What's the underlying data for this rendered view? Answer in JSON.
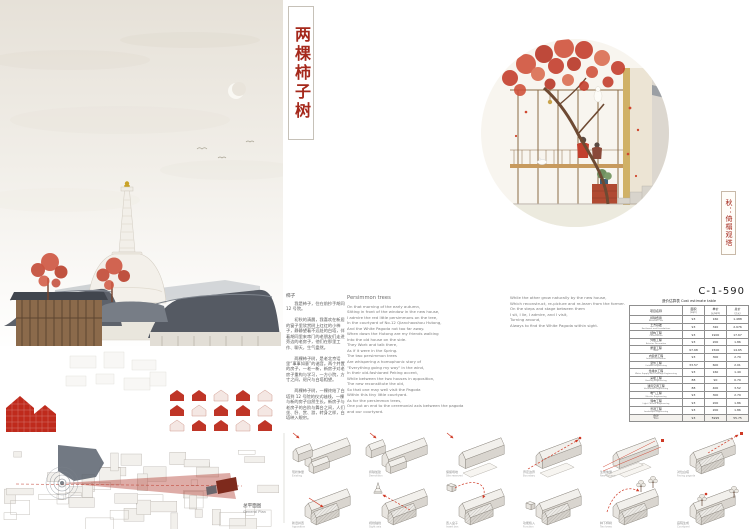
{
  "board": {
    "main_title": "两棵柿子树",
    "drawing_code": "C-1-590",
    "season_caption": "秋：倚榻观塔"
  },
  "poem_cn": {
    "heading": "柿子",
    "paragraphs": [
      "我是柿子，住在前抄手胡同 12 号院。",
      "初秋的清晨，我喜欢在新居的窗子里欣赏树上红红的小柿子，静静望着不远处的白塔，伴着胡同里来串门的老朋友们走进旁边的老房子，他们在那里工作、聊天，生气盎然。",
      "两棵柿子树，是老北京话里“事事如意”的谐音。两个并置的房子，一老一新，新房子对老房子重构与学习，一方小院，方寸之间，咫尺与白塔相望。",
      "两棵柿子树，一棵终结了白塔到 12 号院的仪式轴线，一棵与新的房子自然生长。新房子与老房子的台阶与舞台之间，人们坐、卧、赏、游，转身之样，白塔映入眼帘。"
    ]
  },
  "poem_en": {
    "heading": "Persimmon trees",
    "column1": [
      "On that morning of the early autumn,",
      "Sitting in front of the window in the new house,",
      "I admire the red little persimmons on the tree,",
      "In the courtyard of No.12 Qianchaoshou Hutong,",
      "And the White Pagoda not too far away.",
      "When down the Hutong are my friends walking",
      "Into the old house on the side.",
      "They Work and talk there,",
      "As if it were in the Spring.",
      "The two persimmon trees",
      "Are whispering a homophonic story of",
      "\"Everything going my way\" in the wind,",
      "In their old-fashioned Peking accent,",
      "While between the two houses in apposition,",
      "The new reconstitute the old,",
      "So that one may well visit the Pagoda",
      "Within this tiny little courtyard.",
      "As for the persimmon trees,",
      "One put an end to the ceremonial axis between the pagoda",
      "and our courtyard."
    ],
    "column2": [
      "While the other grow naturally by the new house,",
      "Which reconstruct, re-picture and re-learn from the former.",
      "On the steps and stage between them",
      "I sit, I lie, I admire, and I visit,",
      "Turning around,",
      "Always to find the White Pagoda within sight."
    ]
  },
  "cost_table": {
    "title": "造价估算表 Cost estimate table",
    "headers": {
      "item": "项目名称",
      "area_zh": "面积",
      "area_en": "(sqm)",
      "unit_zh": "单价",
      "unit_en": "(元/sqm)",
      "total_zh": "总价",
      "total_en": "(万元)"
    },
    "rows": [
      {
        "zh": "拆除费用",
        "en": "Removal Cost",
        "area": "93",
        "unit": "160",
        "total": "1.488"
      },
      {
        "zh": "土方基础",
        "en": "Earthwork and Foundations",
        "area": "93",
        "unit": "320",
        "total": "2.976"
      },
      {
        "zh": "结构工程",
        "en": "Construction",
        "area": "93",
        "unit": "1900",
        "total": "17.67"
      },
      {
        "zh": "外檐工程",
        "en": "Exterior Decoration",
        "area": "93",
        "unit": "200",
        "total": "1.86"
      },
      {
        "zh": "屋面工程",
        "en": "Roof",
        "area": "97.68",
        "unit": "1500",
        "total": "14.65"
      },
      {
        "zh": "内装修工程",
        "en": "Interior Decoration",
        "area": "93",
        "unit": "300",
        "total": "2.79"
      },
      {
        "zh": "室外工程",
        "en": "Outdoor Engineering",
        "area": "33.57",
        "unit": "600",
        "total": "2.01"
      },
      {
        "zh": "给排水工程",
        "en": "Water Supply and Drainage Engineering",
        "area": "93",
        "unit": "160",
        "total": "1.49"
      },
      {
        "zh": "采暖工程",
        "en": "Heating Engineering",
        "area": "88",
        "unit": "90",
        "total": "0.79"
      },
      {
        "zh": "通风空调工程",
        "en": "Ventilation Engineering",
        "area": "88",
        "unit": "400",
        "total": "3.52"
      },
      {
        "zh": "电气工程",
        "en": "Electric Engineering",
        "area": "93",
        "unit": "300",
        "total": "2.79"
      },
      {
        "zh": "弱电工程",
        "en": "Light Current Engineering",
        "area": "93",
        "unit": "200",
        "total": "1.86"
      },
      {
        "zh": "景观工程",
        "en": "Landscape Engineering",
        "area": "93",
        "unit": "200",
        "total": "1.86"
      }
    ],
    "total_row": {
      "zh": "合计",
      "en": "Total",
      "area": "93",
      "unit": "5995",
      "total": "55.75"
    }
  },
  "site_plan": {
    "label_zh": "总平面图",
    "label_en": "General Plan"
  },
  "process_diagrams": {
    "captions": [
      {
        "zh": "现状体量",
        "en": "Existing"
      },
      {
        "zh": "拆除加建",
        "en": "Demolition"
      },
      {
        "zh": "保留场地",
        "en": "Site reserved"
      },
      {
        "zh": "界定边界",
        "en": "Boundary"
      },
      {
        "zh": "生成体量",
        "en": "New volume"
      },
      {
        "zh": "对位白塔",
        "en": "Facing pagoda"
      },
      {
        "zh": "新旧并置",
        "en": "Apposition"
      },
      {
        "zh": "视线轴线",
        "en": "Sight axis"
      },
      {
        "zh": "置入盒子",
        "en": "Insert box"
      },
      {
        "zh": "功能植入",
        "en": "Function"
      },
      {
        "zh": "种下柿树",
        "en": "Two trees"
      },
      {
        "zh": "庭院生成",
        "en": "Courtyard"
      }
    ]
  },
  "colors": {
    "accent_red": "#b03a2e",
    "roof_gray": "#5f646c",
    "gold": "#c9a44d"
  }
}
